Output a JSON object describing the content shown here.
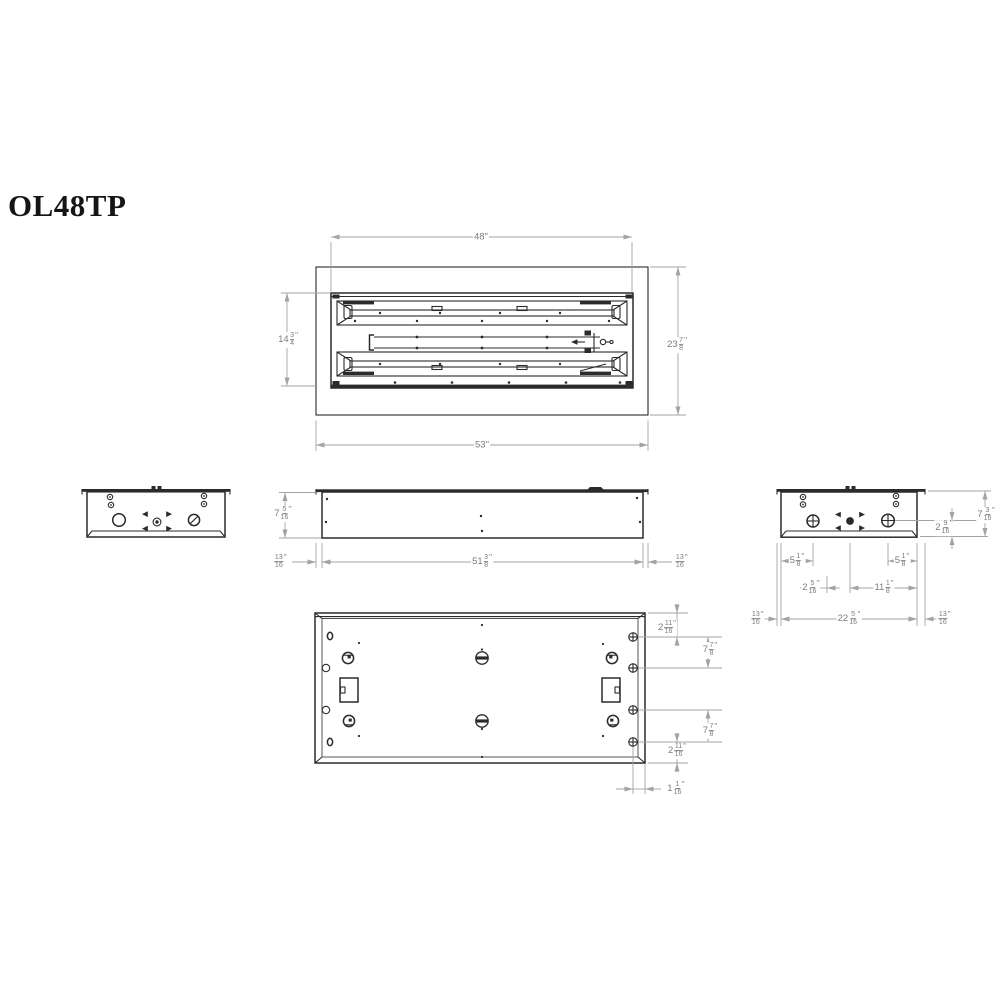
{
  "title": "OL48TP",
  "colors": {
    "line": "#2b2b2b",
    "dimension": "#a3a3a3",
    "dim_text": "#7c7c7c",
    "title_text": "#151515",
    "background": "#ffffff"
  },
  "views": {
    "front": {
      "label_width_top": "48\"",
      "label_width_overall": "53\"",
      "label_height_inner": "14 3/4\"",
      "label_height_overall": "23 7/8\""
    },
    "side": {
      "label_height": "7 5/16\"",
      "label_length": "51 3/8\"",
      "label_flange_left": "13/16\"",
      "label_flange_right": "13/16\""
    },
    "right_end": {
      "label_height": "7 3/16\"",
      "label_knockout_height": "2 9/16\"",
      "label_knockout_left": "5 1/8\"",
      "label_knockout_right": "5 1/8\"",
      "label_center_offset": "2 5/16\"",
      "label_knockout_span": "11 1/8\"",
      "label_width": "22 5/16\"",
      "label_flange_left": "13/16\"",
      "label_flange_right": "13/16\""
    },
    "back": {
      "label_top_offset": "2 11/16\"",
      "label_hole_span_top": "7 7/8\"",
      "label_hole_span_bottom": "7 7/8\"",
      "label_bottom_offset": "2 11/16\"",
      "label_edge_offset": "1 1/16\""
    }
  }
}
